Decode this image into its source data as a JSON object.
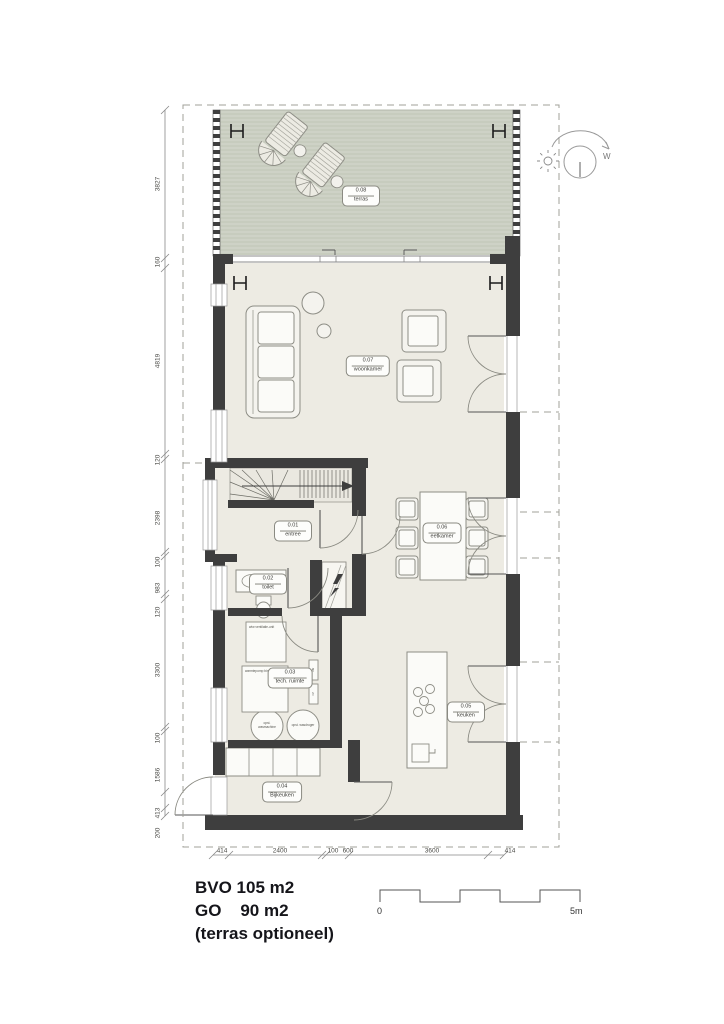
{
  "rooms": [
    {
      "id": "0.01",
      "name": "entree"
    },
    {
      "id": "0.02",
      "name": "toilet"
    },
    {
      "id": "0.03",
      "name": "tech. ruimte"
    },
    {
      "id": "0.04",
      "name": "Bijkeuken"
    },
    {
      "id": "0.05",
      "name": "keuken"
    },
    {
      "id": "0.06",
      "name": "eetkamer"
    },
    {
      "id": "0.07",
      "name": "woonkamer"
    },
    {
      "id": "0.08",
      "name": "terras"
    }
  ],
  "dimensions": {
    "left": [
      "3827",
      "160",
      "4819",
      "120",
      "2398",
      "100",
      "983",
      "120",
      "3300",
      "100",
      "1586",
      "413",
      "200"
    ],
    "bottom": [
      "414",
      "2400",
      "100",
      "600",
      "3600",
      "414"
    ]
  },
  "legend": {
    "line1": "BVO 105 m2",
    "line2": "GO    90 m2",
    "line3": "(terras optioneel)"
  },
  "scale_bar": {
    "start": "0",
    "end": "5m"
  },
  "compass": {
    "west": "W"
  },
  "equipment": {
    "unit1": "wtw ventilatie-unit",
    "unit2": "warmtepomp binnen-unit",
    "mv": "mv",
    "cv": "cv",
    "washer": "opst. wasmachine",
    "dryer": "opst. wasdroger"
  },
  "colors": {
    "wall": "#3e3e3e",
    "floor": "#edebe3",
    "terrace": "#ced2c6",
    "line": "#8d8d85"
  }
}
